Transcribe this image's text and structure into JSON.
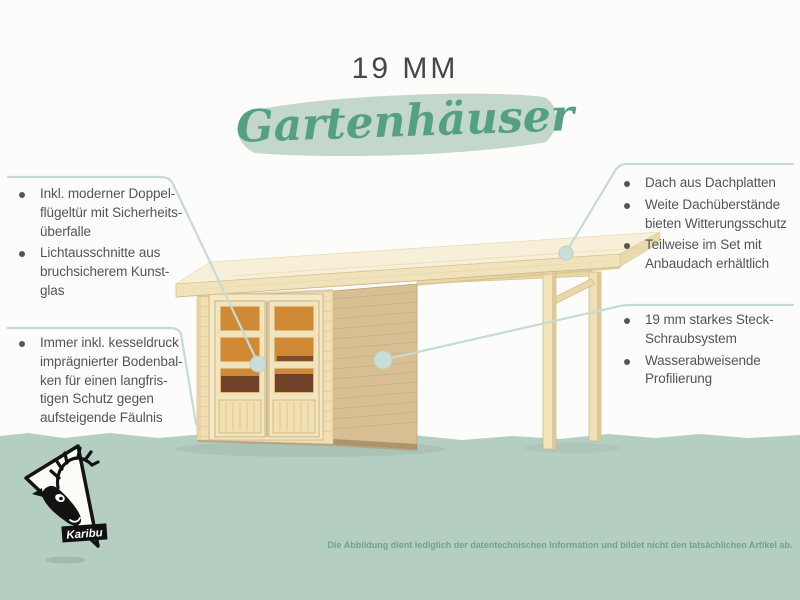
{
  "title": {
    "size_label": "19 MM",
    "product_label": "Gartenhäuser"
  },
  "features": {
    "left_top": {
      "items": [
        "Inkl. moderner Doppel-\nflügeltür mit Sicherheits-\nüberfalle",
        "Lichtausschnitte aus\nbruchsicherem Kunst-\nglas"
      ]
    },
    "left_bottom": {
      "items": [
        "Immer inkl. kesseldruck\nimprägnierter Bodenbal-\nken für einen langfris-\ntigen Schutz gegen\naufsteigende Fäulnis"
      ]
    },
    "right_top": {
      "items": [
        "Dach aus Dachplatten",
        "Weite Dachüberstände\nbieten Witterungsschutz",
        "Teilweise im Set mit\nAnbaudach erhältlich"
      ]
    },
    "right_bottom": {
      "items": [
        "19 mm starkes Steck-\nSchraubsystem",
        "Wasserabweisende\nProfilierung"
      ]
    }
  },
  "logo": {
    "brand": "Karibu"
  },
  "disclaimer": "Die Abbildung dient lediglich der datentechnischen Information und bildet nicht den tatsächlichen Artikel ab.",
  "colors": {
    "band_green": "#b4cec1",
    "accent_green": "#55a083",
    "swoosh_green": "#c3d8cb",
    "callout_line": "#c6dbd5",
    "body_text": "#54555b",
    "wood_front": "#f1dfb2",
    "wood_side": "#d8bf93",
    "roof_top": "#f8efd8",
    "window_orange": "#d08a36",
    "disclaimer_green": "#6fa48c"
  }
}
